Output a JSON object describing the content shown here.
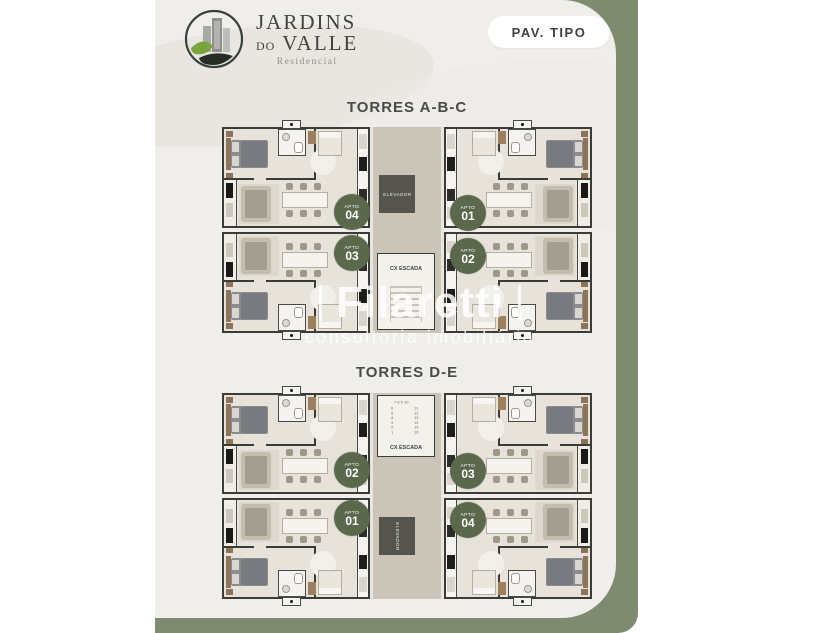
{
  "brand": {
    "line1": "JARDINS",
    "line2_small": "DO",
    "line2": "VALLE",
    "tagline": "Residencial"
  },
  "header": {
    "badge": "PAV. TIPO"
  },
  "watermark": {
    "name": "Filaretti",
    "subtitle": "consultoria imobiliária"
  },
  "colors": {
    "sage_band": "#7e8b71",
    "badge_green": "#5a684c",
    "card_background": "#f0eeea",
    "charcoal_text": "#3e433c",
    "wall": "#3c3c36"
  },
  "plans": [
    {
      "title": "TORRES A-B-C",
      "elevator_label": "ELEVADOR",
      "stairs_label": "CX ESCADA",
      "elevator_position": "top",
      "badges": [
        {
          "side": "left",
          "label": "APTO",
          "number": "04"
        },
        {
          "side": "left",
          "label": "APTO",
          "number": "03"
        },
        {
          "side": "right",
          "label": "APTO",
          "number": "01"
        },
        {
          "side": "right",
          "label": "APTO",
          "number": "02"
        }
      ]
    },
    {
      "title": "TORRES D-E",
      "elevator_label": "ELEVADOR",
      "stairs_label": "CX ESCADA",
      "elevator_position": "bottom",
      "stairs_numbers_top": "7 8 9 10",
      "stairs_numbers_left": "6\n5\n4\n3\n2\n1",
      "stairs_numbers_right": "11\n12\n13\n14\n15\n16",
      "badges": [
        {
          "side": "left",
          "label": "APTO",
          "number": "02"
        },
        {
          "side": "left",
          "label": "APTO",
          "number": "01"
        },
        {
          "side": "right",
          "label": "APTO",
          "number": "03"
        },
        {
          "side": "right",
          "label": "APTO",
          "number": "04"
        }
      ]
    }
  ]
}
